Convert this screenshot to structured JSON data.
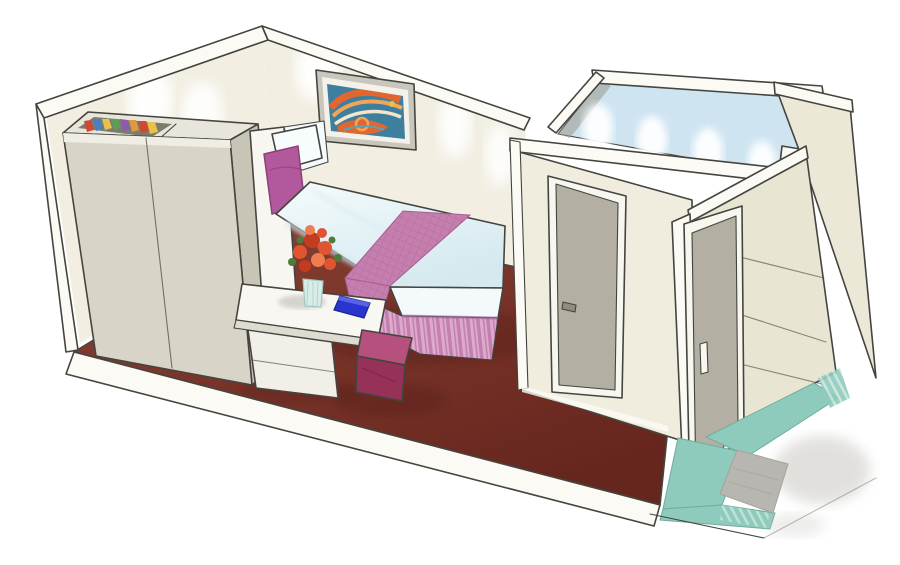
{
  "scene": {
    "subject": "cutaway watercolor illustration of a cruise-ship interior stateroom cabin",
    "view": "isometric cutaway from above-front-right",
    "background": "#ffffff"
  },
  "objects": {
    "left_area": "wardrobe with open top showing folded clothes, white side tower, vanity desk with flower vase and blue book, magenta cube stool",
    "center": "double bed with white duvet, pink quilted runner, pleated pink bed skirt, white and magenta pillows, framed abstract art on rear wall",
    "right_area": "bathroom cube with open top glowing light blue, grey bathroom door, entry corridor with grey entrance door, paneled outer wall, teal tiled entry floor with grey doormat",
    "floor": "dark burgundy carpet on a white platform slab"
  },
  "palette": {
    "ink": "#45443f",
    "band": "#fbfaf5",
    "wall": "#f2efe2",
    "glow": "#ffffff",
    "artFrame": "#c9c6bc",
    "artMat": "#f3f1e9",
    "artBg": "#3e7f9f",
    "artOrange": "#e2672f",
    "artOrangeLight": "#f2a557",
    "artCream": "#f3e6c9",
    "artTeal": "#57a3b8",
    "artYellow": "#e7c24a",
    "wardrobeFront": "#d8d5c8",
    "wardrobeSide": "#c9c5b6",
    "wardrobeTop": "#e8e5da",
    "wardrobeRim": "#efede4",
    "wardrobeInterior": "#7d7a6e",
    "clothes1": "#cf4a33",
    "clothes2": "#4a7fc0",
    "clothes3": "#e7c24a",
    "clothes4": "#5d9e57",
    "clothes5": "#8e5ab0",
    "clothes6": "#e09a3e",
    "tower": "#f7f6f0",
    "floorLight": "#8a4334",
    "floorMid": "#7b352a",
    "floorDark": "#66261e",
    "floorShadow": "#4f1d16",
    "deskTop": "#f8f7f2",
    "deskEdge": "#dedbd1",
    "deskCabinet": "#f1efe7",
    "deskShadow": "#5a5850",
    "vaseGlass": "#d9ece8",
    "vaseStripe": "#a8cfc9",
    "flower": "#e05531",
    "flowerDark": "#c23d1f",
    "flowerLight": "#f07d4e",
    "leaf": "#4d7c3c",
    "book": "#2936cd",
    "bookLight": "#5a63e6",
    "duvet": "#f4fbfc",
    "duvetShade": "#d5e9ef",
    "mattress": "#f4fafb",
    "runner": "#c57fae",
    "runnerDark": "#a75e92",
    "skirt": "#dfa9cc",
    "skirtStripe": "#c27fb0",
    "skirtShadow": "#a86b9e",
    "pillowWhite": "#f7fcfd",
    "pillowPink": "#b2589c",
    "pillowPinkDark": "#8d4078",
    "stoolTop": "#b5517c",
    "stoolFront": "#963158",
    "stoolCrease": "#7c2748",
    "bathWall": "#f0eddf",
    "bathWallSide": "#e9e5d3",
    "door": "#b3afa2",
    "doorFrame": "#f7f6ef",
    "handle": "#8f8c80",
    "bathBlue": "#cfe4f1",
    "bathShade": "#9a978a",
    "entryWall": "#ece8d8",
    "teal": "#8ecbbc",
    "tealLight": "#c3e4da",
    "tealEdge": "#6fae9f",
    "mat": "#b8b6b0",
    "shadowSoft": "#c5c3bd"
  }
}
